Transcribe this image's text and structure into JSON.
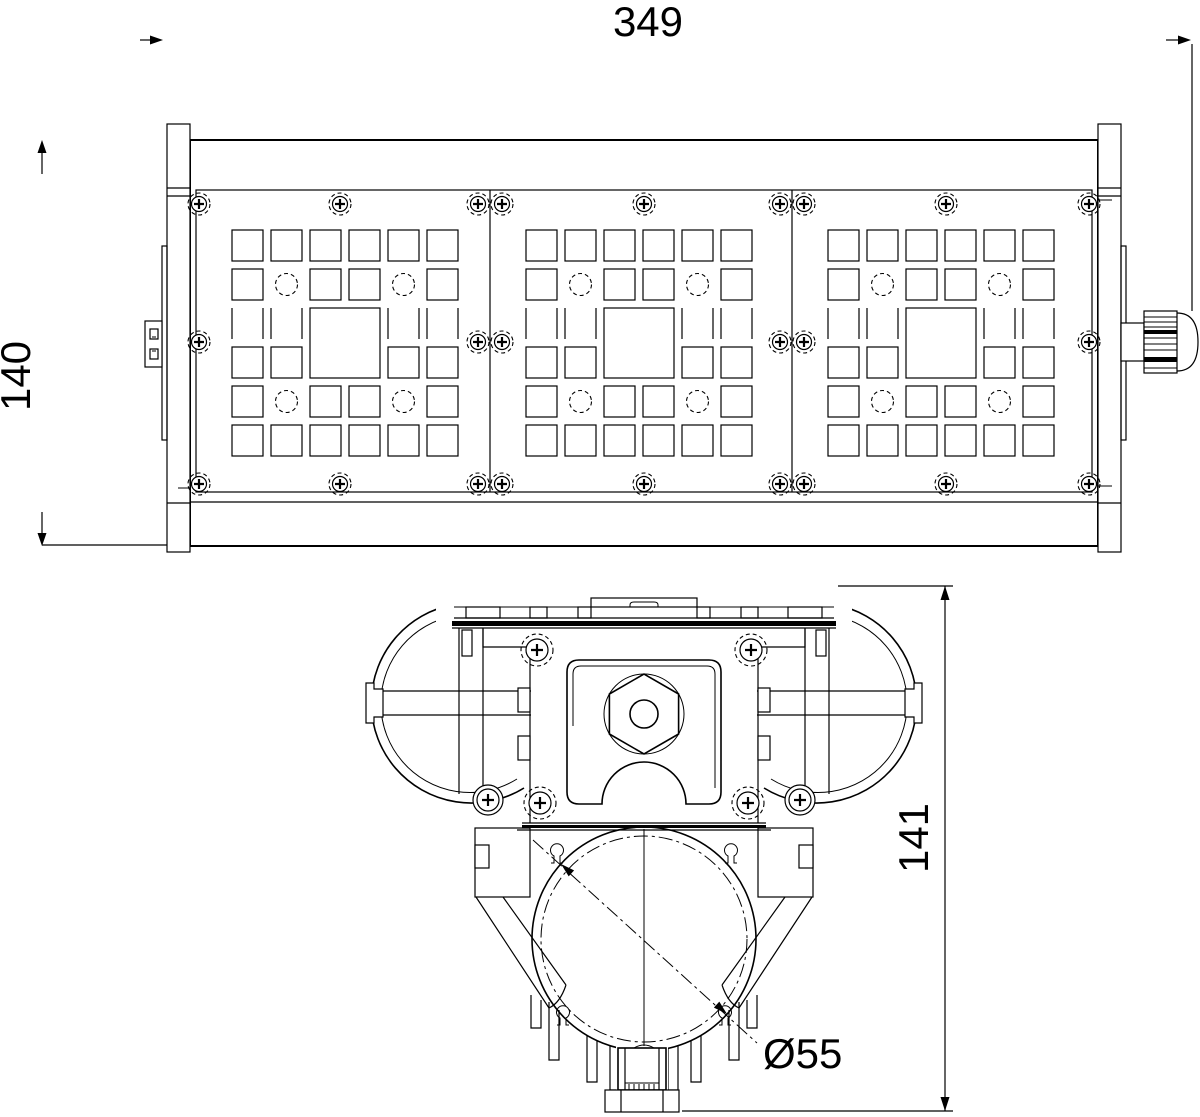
{
  "page": {
    "background": "#ffffff",
    "stroke_color": "#000000",
    "drawing_type": "technical dimension drawing of modular LED flood light"
  },
  "front_view": {
    "width_dimension": "349",
    "height_dimension": "140",
    "modules_count": 3
  },
  "section_view": {
    "height_dimension": "141",
    "diameter_dimension": "Ø55"
  }
}
